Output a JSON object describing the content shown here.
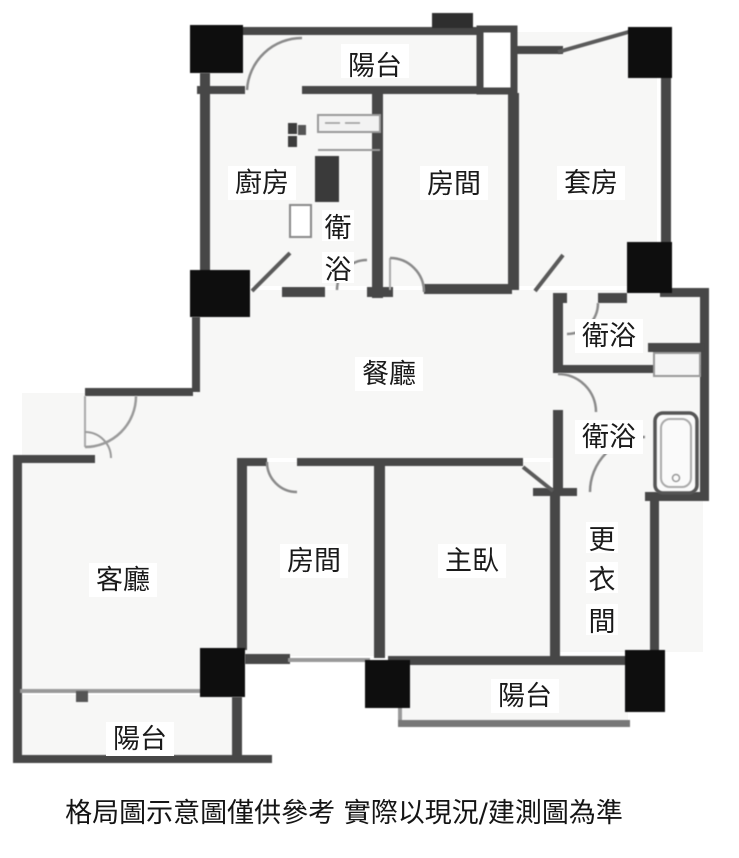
{
  "rooms": {
    "balcony_top": {
      "label": "陽台"
    },
    "kitchen": {
      "label": "廚房"
    },
    "bath_vestibule": {
      "label": "衛浴",
      "chars": [
        "衛",
        "浴"
      ]
    },
    "bedroom_top": {
      "label": "房間"
    },
    "suite": {
      "label": "套房"
    },
    "bath_upper": {
      "label": "衛浴"
    },
    "bath_lower": {
      "label": "衛浴"
    },
    "dining": {
      "label": "餐廳"
    },
    "living": {
      "label": "客廳"
    },
    "bedroom_bottom": {
      "label": "房間"
    },
    "master": {
      "label": "主臥"
    },
    "dressing": {
      "label": "更衣間",
      "chars": [
        "更",
        "衣",
        "間"
      ]
    },
    "balcony_bottom_right": {
      "label": "陽台"
    },
    "balcony_bottom_left": {
      "label": "陽台"
    }
  },
  "caption": {
    "text": "格局圖示意圖僅供參考  實際以現況/建測圖為準"
  },
  "colors": {
    "wall": "#474747",
    "column": "#0e0e0e",
    "thin_line": "#999999",
    "slash": "#5a5a5a",
    "door_arc": "#8a8a8a",
    "text": "#1a1a1a",
    "background": "#ffffff",
    "floor": "#f7f7f6"
  }
}
